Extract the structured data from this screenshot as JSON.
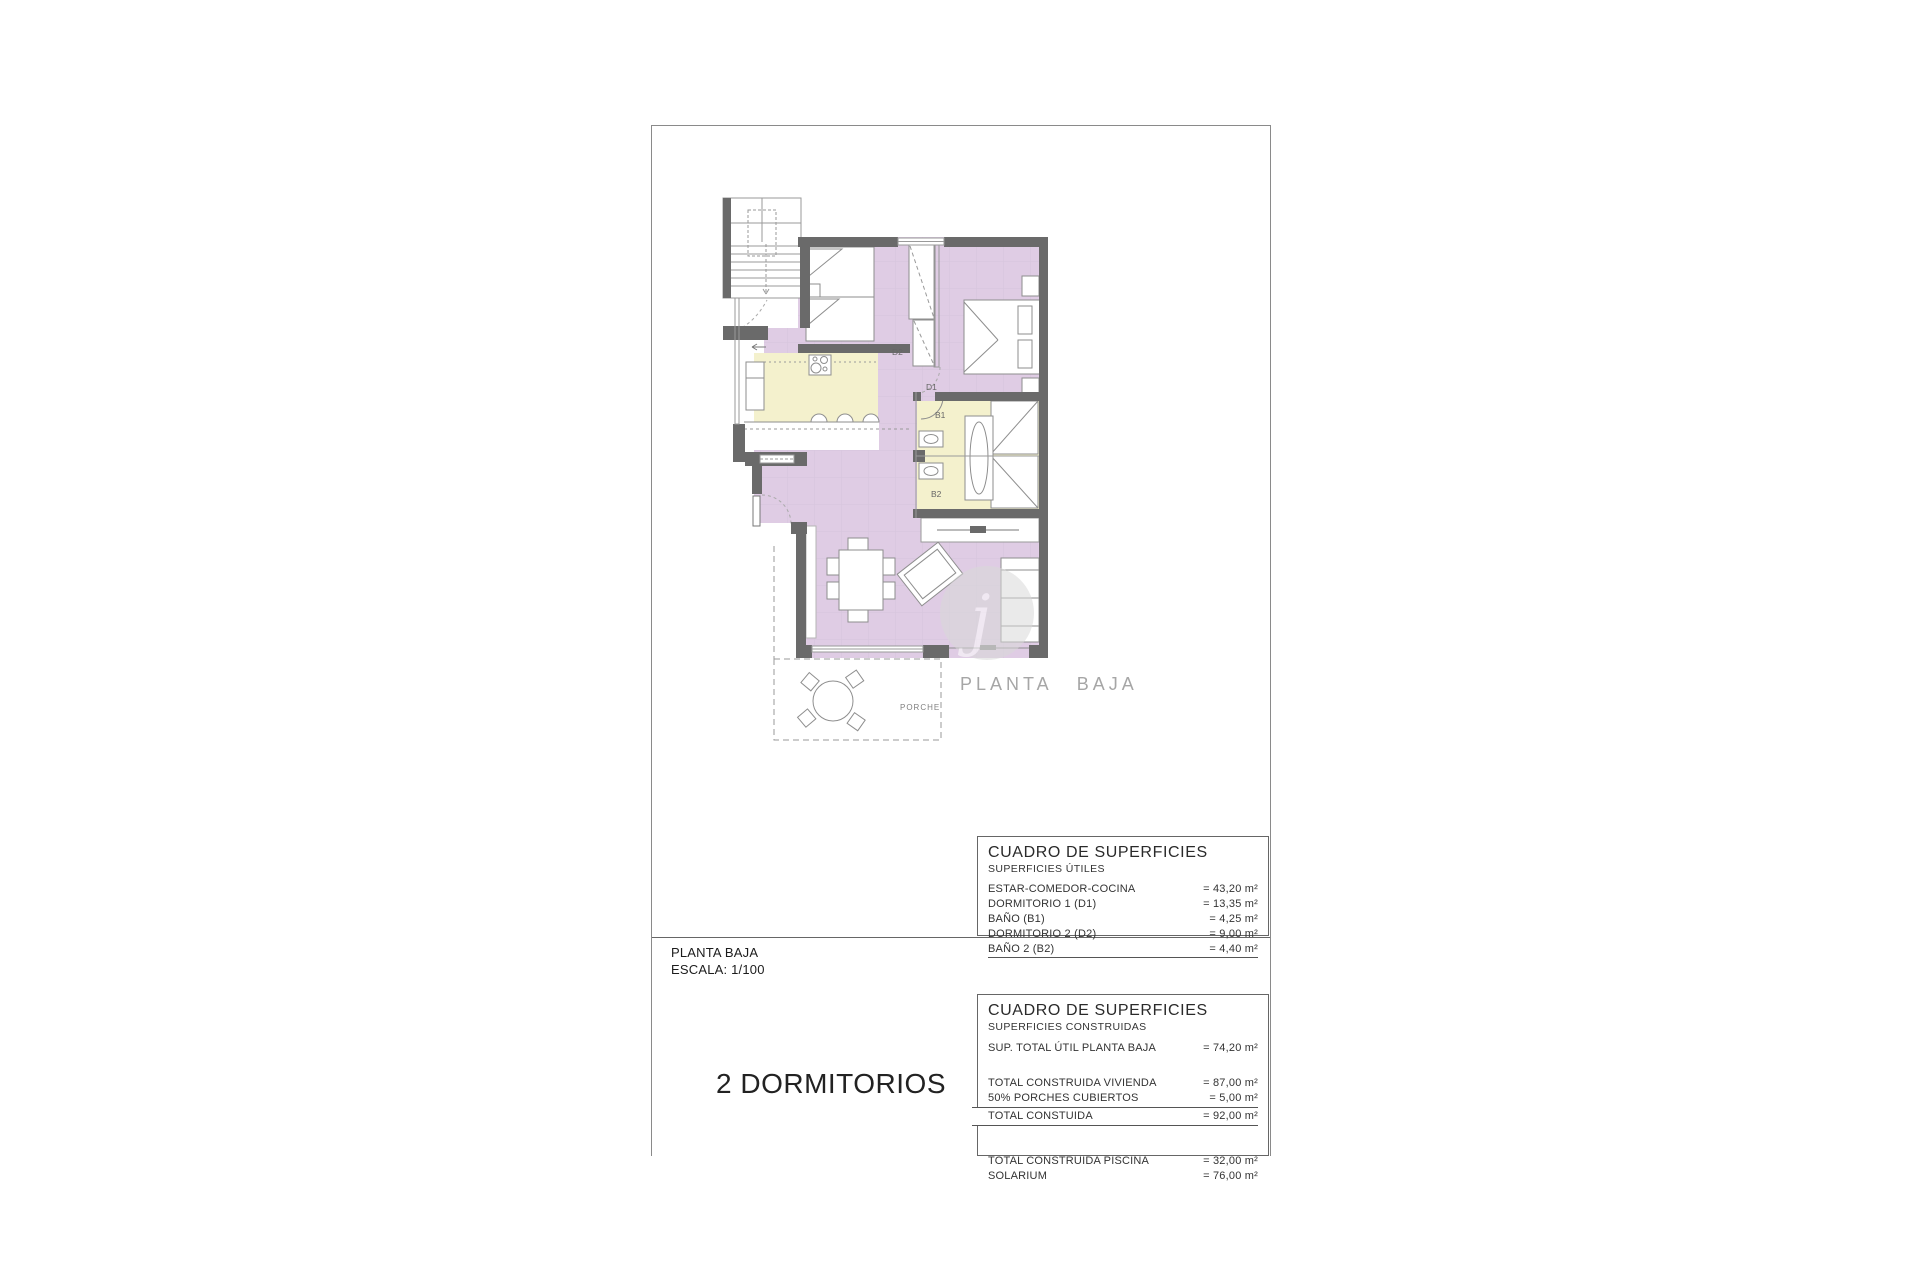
{
  "sheet": {
    "plan_label": "PLANTA BAJA",
    "porch_label": "PORCHE",
    "watermark_letter": "j",
    "room_labels": {
      "d1": "D1",
      "d2": "D2",
      "b1": "B1",
      "b2": "B2"
    },
    "scale_block": {
      "line1": "PLANTA BAJA",
      "line2": "ESCALA: 1/100"
    },
    "type_label": "2 DORMITORIOS"
  },
  "tables": {
    "utiles": {
      "title": "CUADRO DE SUPERFICIES",
      "subtitle": "SUPERFICIES ÚTILES",
      "rows": [
        {
          "label": "ESTAR-COMEDOR-COCINA",
          "value": "= 43,20 m²"
        },
        {
          "label": "DORMITORIO 1 (D1)",
          "value": "= 13,35 m²"
        },
        {
          "label": "BAÑO  (B1)",
          "value": "= 4,25 m²"
        },
        {
          "label": "DORMITORIO 2 (D2)",
          "value": "= 9,00 m²"
        },
        {
          "label": "BAÑO 2 (B2)",
          "value": "= 4,40 m²"
        }
      ]
    },
    "construidas": {
      "title": "CUADRO DE SUPERFICIES",
      "subtitle": "SUPERFICIES CONSTRUIDAS",
      "rows_a": [
        {
          "label": "SUP. TOTAL ÚTIL PLANTA BAJA",
          "value": "= 74,20 m²"
        }
      ],
      "rows_b": [
        {
          "label": "TOTAL CONSTRUIDA VIVIENDA",
          "value": "= 87,00 m²"
        },
        {
          "label": "50% PORCHES CUBIERTOS",
          "value": "= 5,00 m²"
        }
      ],
      "total_row": {
        "label": "TOTAL CONSTUIDA",
        "value": "= 92,00 m²"
      },
      "rows_c": [
        {
          "label": "TOTAL CONSTRUIDA PISCINA",
          "value": "= 32,00 m²"
        },
        {
          "label": "SOLARIUM",
          "value": "= 76,00 m²"
        }
      ]
    }
  },
  "colors": {
    "room_lilac": "#dfcce4",
    "room_yellow": "#f4f1cd",
    "wall_dark": "#6a6a6a",
    "line_gray": "#8e8e8e",
    "frame_gray": "#8a8a8a",
    "label_gray": "#a6a6a6"
  }
}
